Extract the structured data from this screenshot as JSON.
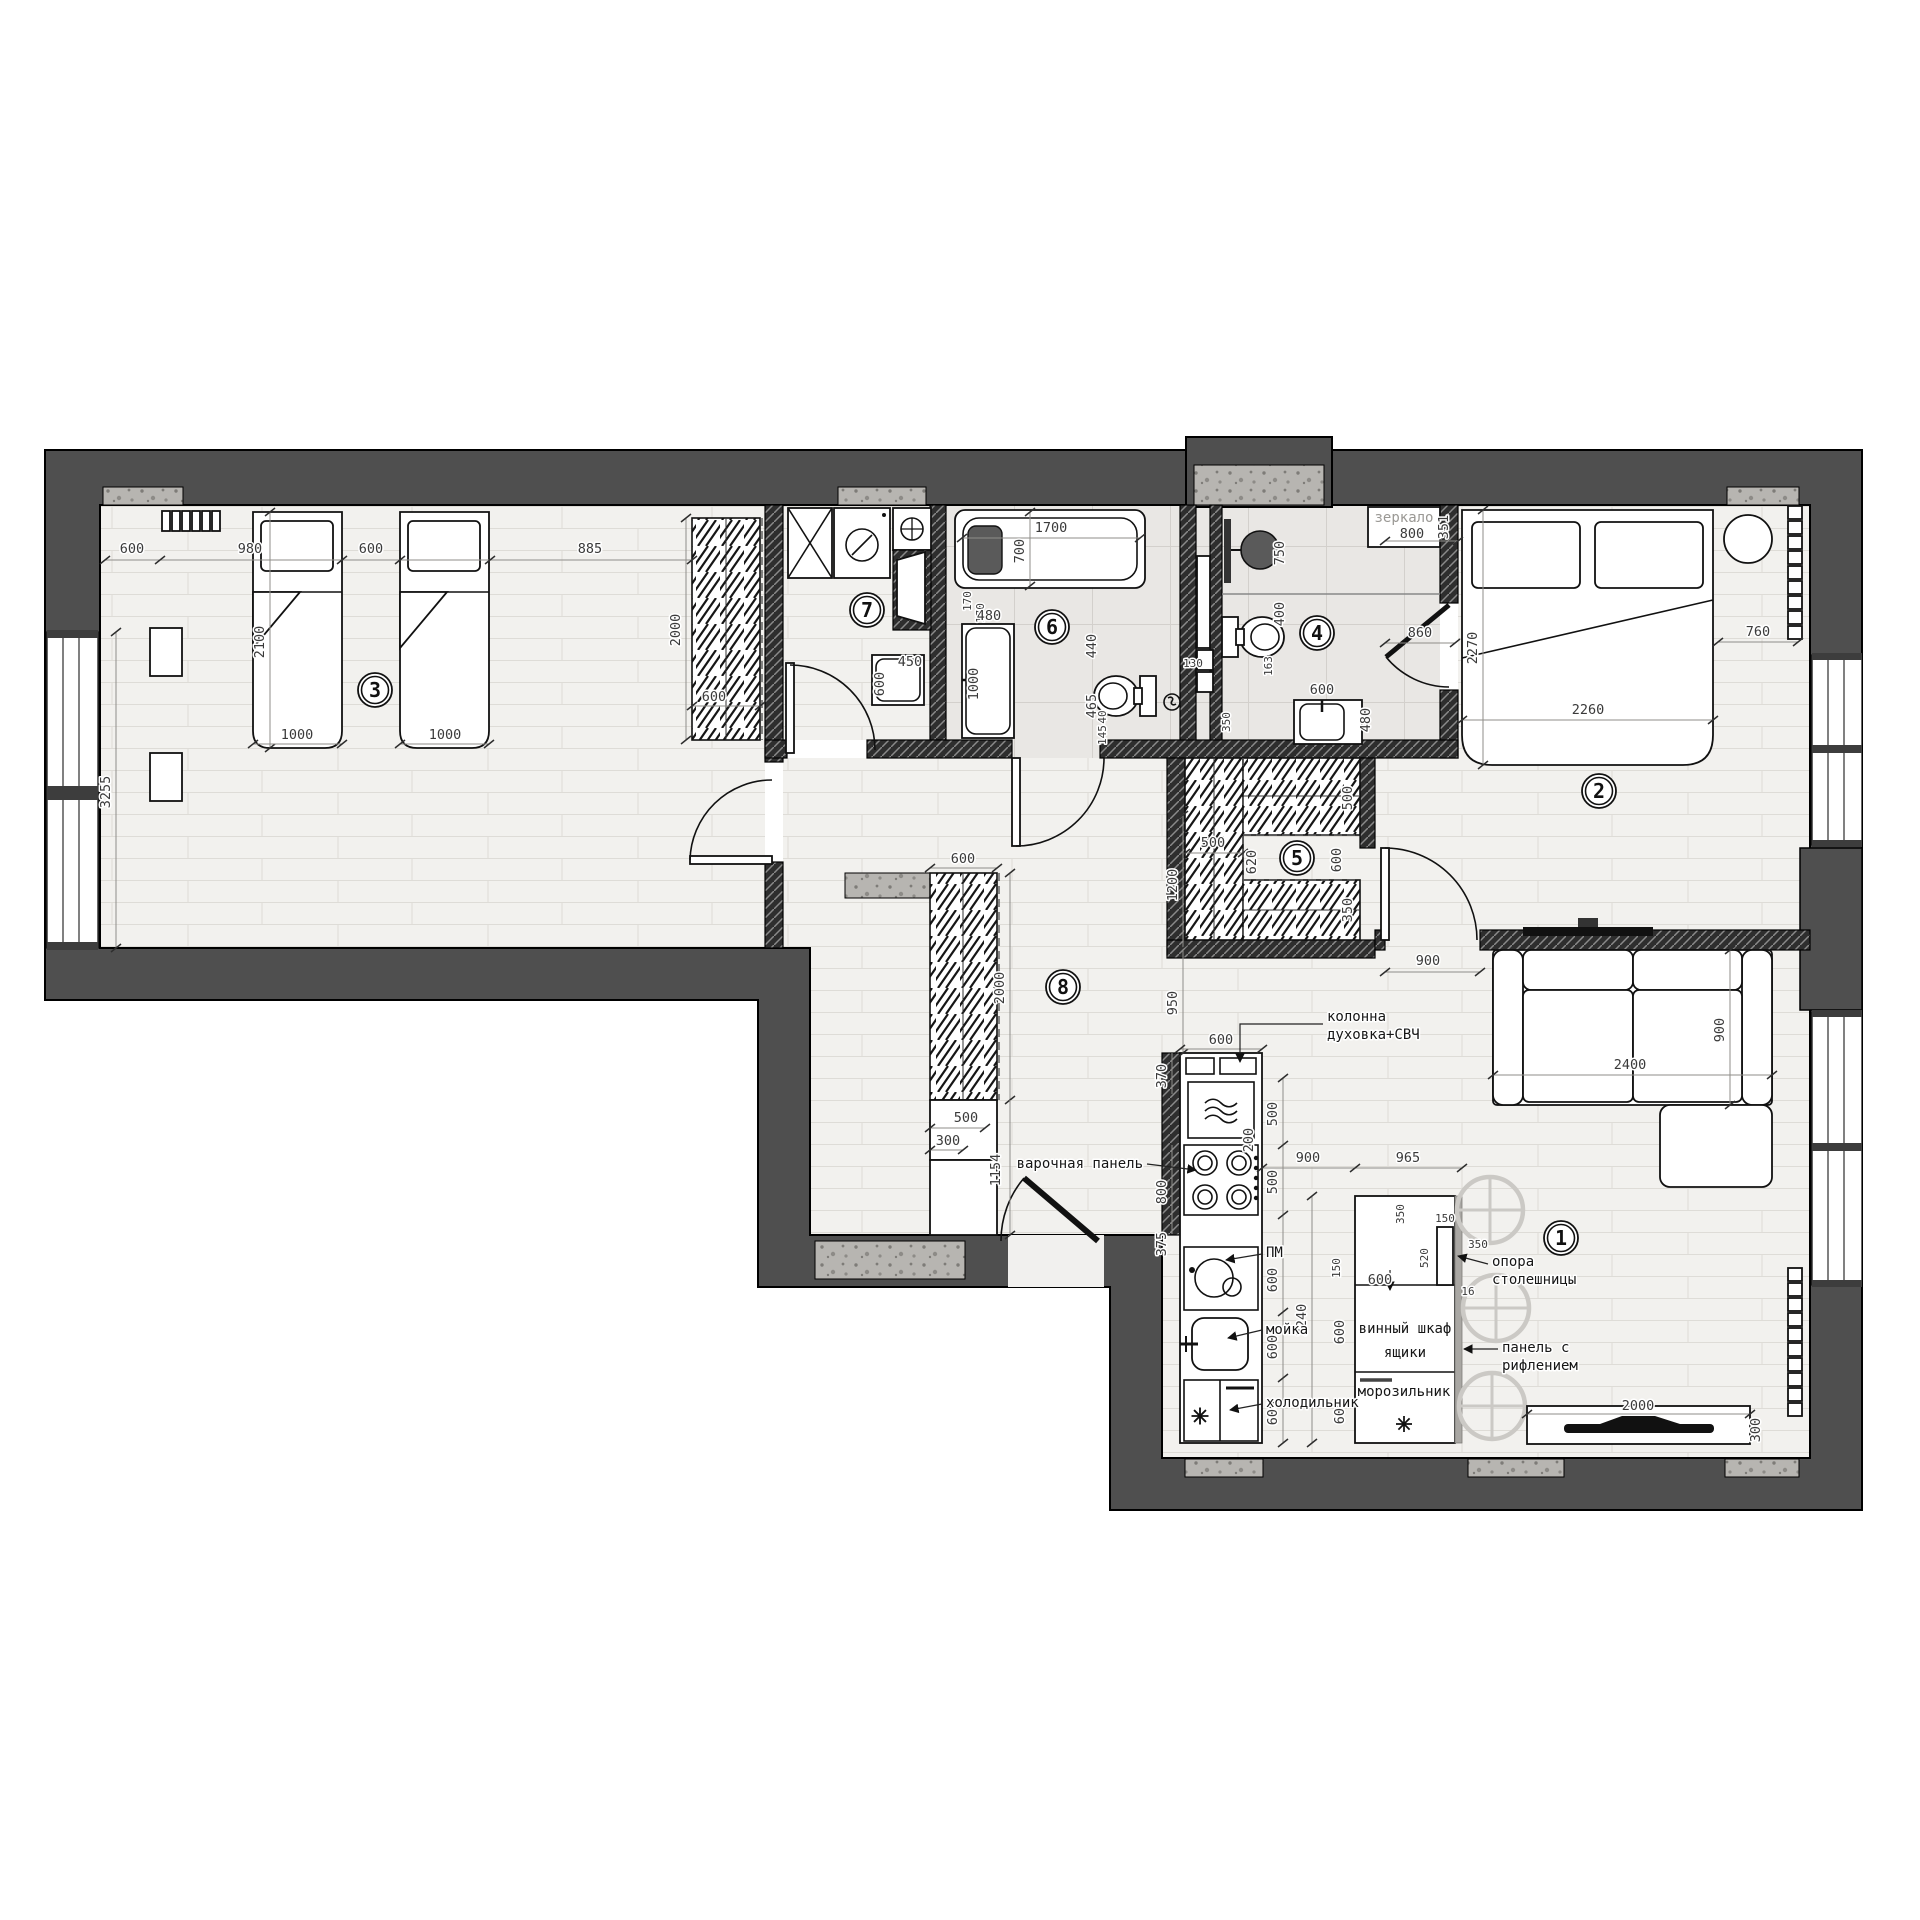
{
  "plan": {
    "rooms": {
      "living": "1",
      "bedroom": "2",
      "kids": "3",
      "bath2": "4",
      "wardrobe": "5",
      "bath1": "6",
      "laundry": "7",
      "hall": "8"
    },
    "labels": {
      "mirror": "зеркало",
      "column1": "колонна",
      "column2": "духовка+СВЧ",
      "hob": "варочная панель",
      "dishwasher": "ПМ",
      "sink": "мойка",
      "fridge": "холодильник",
      "wine": "винный шкаф",
      "drawers": "ящики",
      "freezer": "морозильник",
      "support1": "опора",
      "support2": "столешницы",
      "fluted1": "панель с",
      "fluted2": "рифлением"
    },
    "dims": {
      "r3_a": "600",
      "r3_b": "980",
      "r3_c": "600",
      "r3_d": "885",
      "r3_win": "3255",
      "r3_bedlen": "2100",
      "r3_bed1": "1000",
      "r3_bed2": "1000",
      "r3_wardlen": "2000",
      "r3_wardw": "600",
      "r7_w": "450",
      "r7_d": "600",
      "r6_tublen": "1700",
      "r6_tubw": "700",
      "r6_170a": "170",
      "r6_170b": "170",
      "r6_van480": "480",
      "r6_van1000": "1000",
      "r6_wc440": "440",
      "r6_wc465": "465",
      "r6_wc40": "40",
      "r6_wc145": "145",
      "r6_wall130": "130",
      "r4_sh750": "750",
      "r4_400": "400",
      "r4_163": "163",
      "r4_350": "350",
      "r4_van600": "600",
      "r4_van480": "480",
      "r4_mir800": "800",
      "r4_mir351": "351",
      "r2_door860": "860",
      "r2_bed2270": "2270",
      "r2_bed2260": "2260",
      "r2_760": "760",
      "r2_door900": "900",
      "r2_sofa2400": "2400",
      "r2_sofa900": "900",
      "r5_500a": "500",
      "r5_620": "620",
      "r5_1470": "1470",
      "r5_600": "600",
      "r5_500b": "500",
      "r5_350": "350",
      "r8_ward600": "600",
      "r8_ward2000": "2000",
      "r8_500": "500",
      "r8_300": "300",
      "r8_1154": "1154",
      "r8_950": "950",
      "r8_1200": "1200",
      "k_600": "600",
      "k_370": "370",
      "k_200": "200",
      "k_800": "800",
      "k_375": "375",
      "k_500a": "500",
      "k_500b": "500",
      "k_600a": "600",
      "k_600b": "600",
      "k_600c": "600",
      "k_2240": "2240",
      "i_900": "900",
      "i_965": "965",
      "i_350a": "350",
      "i_150a": "150",
      "i_520": "520",
      "i_350b": "350",
      "i_16": "16",
      "i_600a": "600",
      "i_150b": "150",
      "i_600b": "600",
      "i_600c": "600",
      "tv_2000": "2000",
      "tv_300": "300"
    }
  }
}
